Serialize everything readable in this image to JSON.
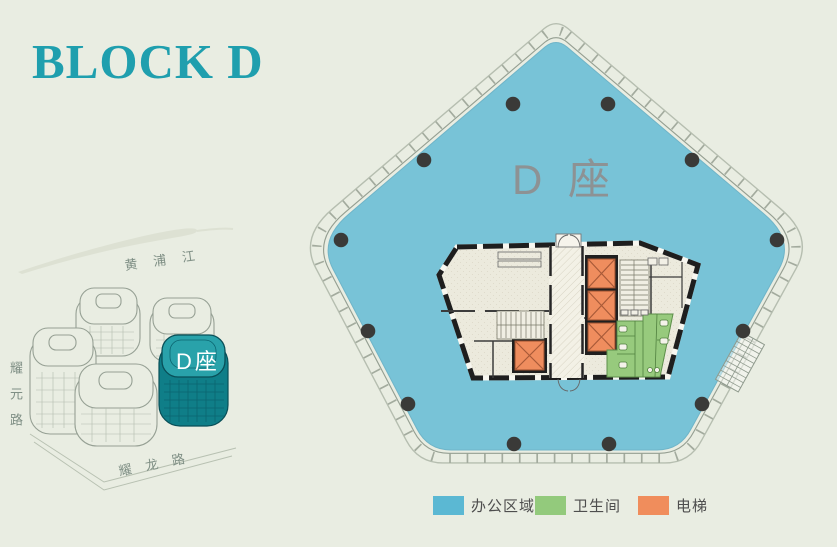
{
  "title": "BLOCK D",
  "site_map": {
    "river_label": "黄浦江",
    "left_road_label": "耀元路",
    "bottom_road_label": "耀龙路",
    "highlighted_building_label": "D座"
  },
  "floor_plan": {
    "building_label": "D 座"
  },
  "legend": {
    "office": {
      "label": "办公区域",
      "color": "#5bb8d3"
    },
    "restroom": {
      "label": "卫生间",
      "color": "#93ca7c"
    },
    "elevator": {
      "label": "电梯",
      "color": "#f08d5c"
    }
  },
  "colors": {
    "background": "#e9ede2",
    "title_text": "#1f9fae",
    "office_area_fill": "#78c3d7",
    "core_fill": "#eceadd",
    "column_fill": "#3a3a38",
    "highlighted_building_fill": "#0f7e88",
    "plan_label_text": "#8d9294",
    "road_label_text": "#7f8f85"
  }
}
